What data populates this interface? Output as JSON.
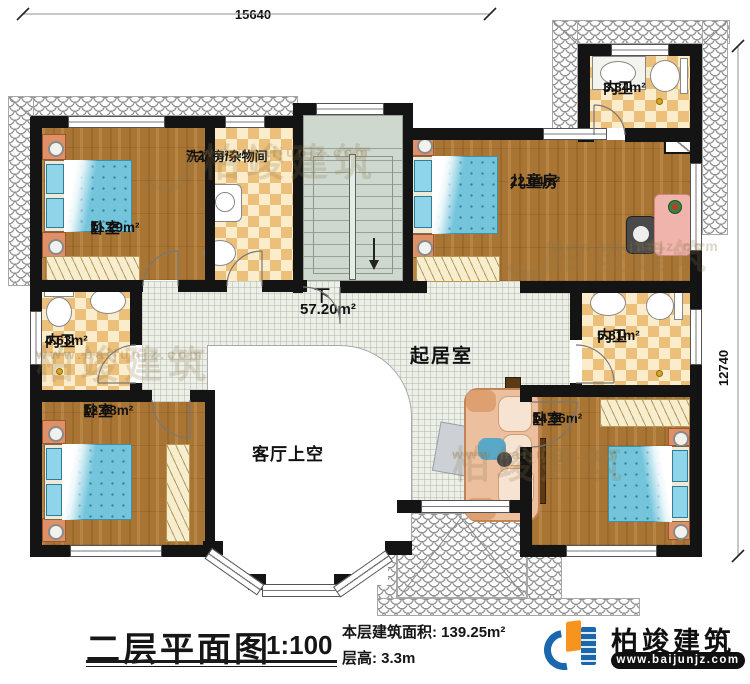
{
  "dimensions": {
    "top": "15640",
    "right": "12740"
  },
  "rooms": {
    "bedroom_tl": {
      "name": "卧室",
      "area": "11.29m²"
    },
    "laundry": {
      "name": "洗衣房/杂物间",
      "area": "7.26m²"
    },
    "children": {
      "name": "儿童房",
      "area": "22.04m²"
    },
    "bath_tr": {
      "name": "内卫",
      "area": "3.84m²"
    },
    "bath_left": {
      "name": "内卫",
      "area": "4.63m²"
    },
    "bath_right": {
      "name": "内卫",
      "area": "5.81m²"
    },
    "bedroom_bl": {
      "name": "卧室",
      "area": "12.68m²"
    },
    "bedroom_br": {
      "name": "卧室",
      "area": "14.36m²"
    },
    "living": {
      "name": "起居室",
      "area": "57.20m²"
    },
    "void": {
      "name": "客厅上空"
    },
    "stairs": {
      "direction": "下"
    }
  },
  "title_block": {
    "title": "二层平面图",
    "scale": "1:100",
    "area_label": "本层建筑面积:",
    "area_value": "139.25m²",
    "height_label": "层高:",
    "height_value": "3.3m"
  },
  "brand": {
    "name": "柏竣建筑",
    "website": "www.baijunjz.com"
  },
  "colors": {
    "wall": "#141414",
    "wood_floor": "#a97534",
    "bath_checker": "#ecc07b",
    "living_tile": "#edefe9",
    "stair": "#cfd8cf",
    "bed_blue": "#74c5dc",
    "brand_blue": "#1b67ad",
    "brand_orange": "#f7941d"
  }
}
